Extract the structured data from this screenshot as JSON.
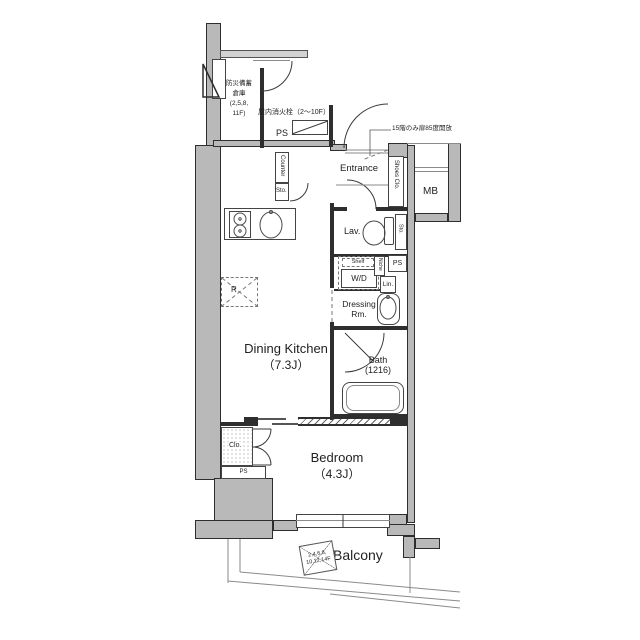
{
  "rooms": {
    "dining_kitchen_name": "Dining Kitchen",
    "dining_kitchen_size": "（7.3J）",
    "bedroom_name": "Bedroom",
    "bedroom_size": "（4.3J）",
    "entrance": "Entrance",
    "lavatory": "Lav.",
    "dressing_line1": "Dressing",
    "dressing_line2": "Rm.",
    "bath_line1": "Bath",
    "bath_line2": "(1216)",
    "balcony": "Balcony",
    "meter_box": "MB"
  },
  "fixtures": {
    "counter": "Counter",
    "hall_storage": "Sto.",
    "lav_storage": "Sto.",
    "shelf": "Shelf",
    "washer_dryer": "W/D",
    "niche": "Niche",
    "linen": "Lin.",
    "shoes_closet": "Shoes Clo.",
    "closet": "Clo.",
    "refrigerator": "R"
  },
  "shafts": {
    "ps_hydrant": "PS",
    "ps_wd": "PS",
    "ps_bedroom": "PS"
  },
  "annotations": {
    "disaster_storage_l1": "防災備蓄",
    "disaster_storage_l2": "倉庫",
    "disaster_storage_l3": "(2,5,8,",
    "disaster_storage_l4": "11F)",
    "indoor_hydrant": "屋内消火栓（2～10F）",
    "door_open_note": "15階のみ扉85度開放",
    "partition_l1": "2,4,6,8,",
    "partition_l2": "10,12,14F"
  },
  "colors": {
    "wall_fill": "#b9b9b9",
    "wall_fill_light": "#d2d2d2",
    "line": "#2e2e2e",
    "text": "#1f1f1f",
    "background": "#ffffff"
  }
}
